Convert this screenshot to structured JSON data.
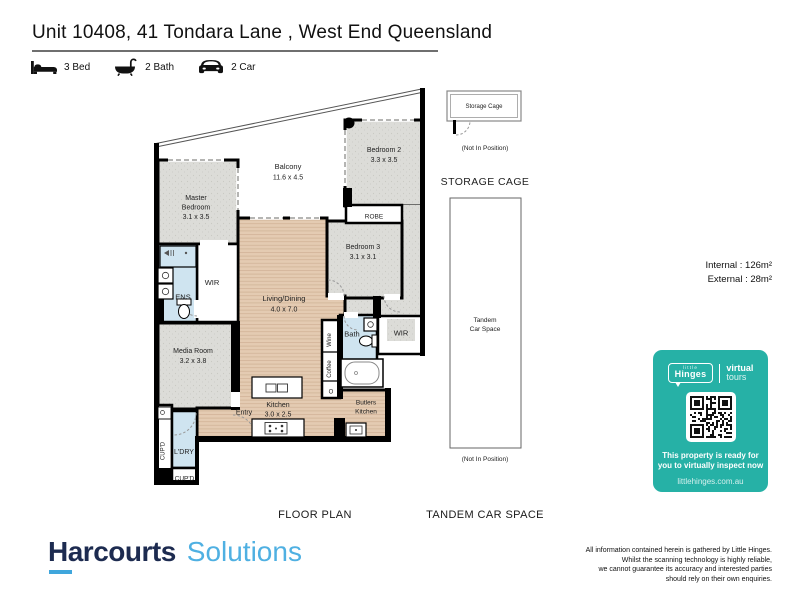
{
  "header": {
    "title": "Unit 10408, 41 Tondara Lane , West End Queensland",
    "features": [
      {
        "icon": "bed-icon",
        "label": "3 Bed"
      },
      {
        "icon": "bath-icon",
        "label": "2 Bath"
      },
      {
        "icon": "car-icon",
        "label": "2 Car"
      }
    ]
  },
  "floor_plan": {
    "section_label": "FLOOR PLAN",
    "rooms": {
      "balcony": {
        "name": "Balcony",
        "dims": "11.6 x 4.5"
      },
      "master": {
        "name_line1": "Master",
        "name_line2": "Bedroom",
        "dims": "3.1 x 3.5"
      },
      "bedroom2": {
        "name": "Bedroom 2",
        "dims": "3.3 x 3.5"
      },
      "bedroom3": {
        "name": "Bedroom 3",
        "dims": "3.1 x 3.1"
      },
      "living": {
        "name": "Living/Dining",
        "dims": "4.0 x 7.0"
      },
      "media": {
        "name": "Media Room",
        "dims": "3.2 x 3.8"
      },
      "kitchen": {
        "name": "Kitchen",
        "dims": "3.0 x 2.5"
      },
      "butlers": {
        "name_line1": "Butlers",
        "name_line2": "Kitchen"
      },
      "robe": "ROBE",
      "wir_master": "WIR",
      "wir_bath": "WIR",
      "ens": "ENS",
      "bath": "Bath",
      "wine": "Wine",
      "coffee": "Coffee",
      "oven": "O",
      "entry": "Entry",
      "laundry": "L'DRY",
      "cupboard_side": "CUP'D",
      "cupboard_bottom": "CUP'D"
    }
  },
  "storage_cage": {
    "section_label": "STORAGE CAGE",
    "unit_label": "Storage Cage",
    "note": "(Not In Position)"
  },
  "tandem": {
    "section_label": "TANDEM CAR SPACE",
    "label_line1": "Tandem",
    "label_line2": "Car Space",
    "note": "(Not In Position)"
  },
  "areas": {
    "internal": "Internal : 126m²",
    "external": "External : 28m²"
  },
  "badge": {
    "color": "#26b1a6",
    "brand_small": "little",
    "brand": "Hinges",
    "product_line1": "virtual",
    "product_line2": "tours",
    "message_line1": "This property is ready for",
    "message_line2": "you to virtually inspect now",
    "url": "littlehinges.com.au"
  },
  "footer": {
    "brand_primary": "Harcourts",
    "brand_secondary": "Solutions",
    "disclaimer": [
      "All information contained herein is gathered by Little Hinges.",
      "Whilst the scanning technology is highly reliable,",
      "we cannot guarantee its accuracy and interested parties",
      "should rely on their own enquiries."
    ]
  }
}
